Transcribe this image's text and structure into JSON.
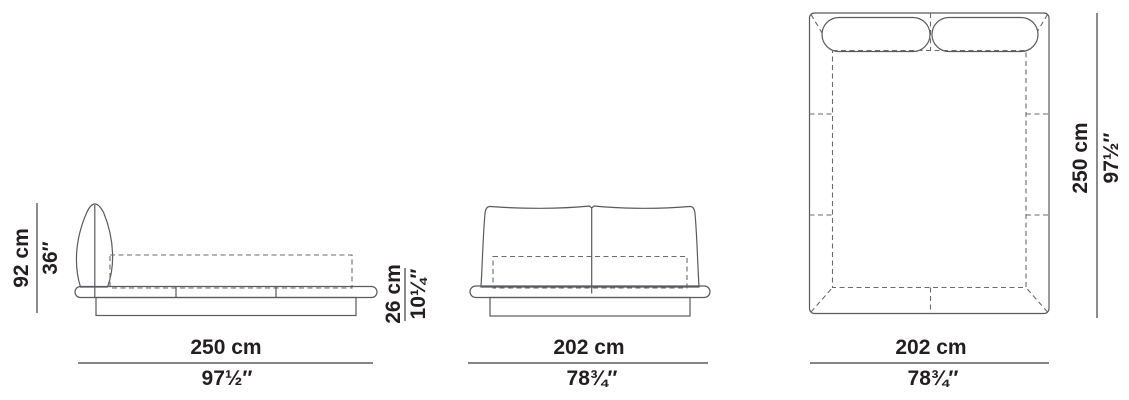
{
  "page": {
    "background": "#ffffff",
    "line_color": "#595a5e",
    "text_color": "#231f20"
  },
  "dimensions": {
    "height": {
      "cm": "92 cm",
      "inches": "36″"
    },
    "base": {
      "cm": "26 cm",
      "inches": "10¼″"
    },
    "length_side": {
      "cm": "250 cm",
      "inches": "97½″"
    },
    "width_front": {
      "cm": "202 cm",
      "inches": "78¾″"
    },
    "width_top": {
      "cm": "202 cm",
      "inches": "78¾″"
    },
    "length_top": {
      "cm": "250 cm",
      "inches": "97½″"
    }
  }
}
